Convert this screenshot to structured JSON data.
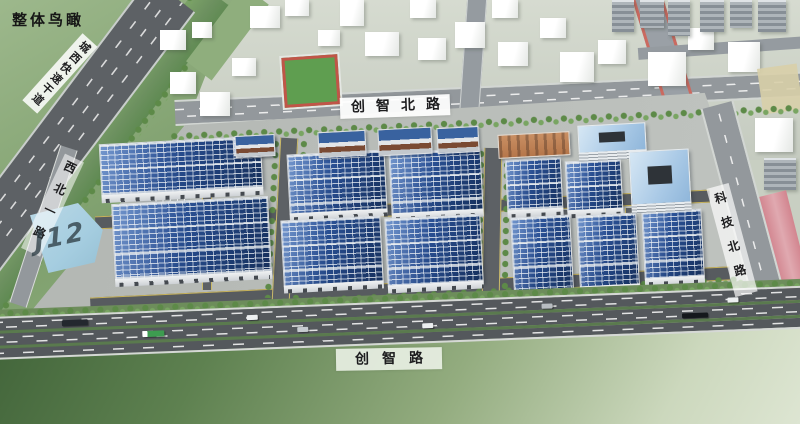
{
  "title": "整体鸟瞰",
  "labels": {
    "expressway": "城西快速干道",
    "road_west": "西北一路",
    "road_north": "创智北路",
    "road_east": "科技北路",
    "road_south": "创智路",
    "plot": "J12"
  },
  "colors": {
    "solar-dark": "#16305c",
    "solar-mid": "#2c5398",
    "grass-dark": "#3f6238",
    "canal-green": "#6d9160",
    "tree-green": "#5d8a48",
    "road-asphalt": "#5d6165",
    "road-light": "#93989c",
    "water": "#a5cde0",
    "track-pink": "#d2858f",
    "dorm-orange": "#c98f63",
    "office-roof": "#a9c9e6",
    "label-ink": "#1d1d1f"
  }
}
